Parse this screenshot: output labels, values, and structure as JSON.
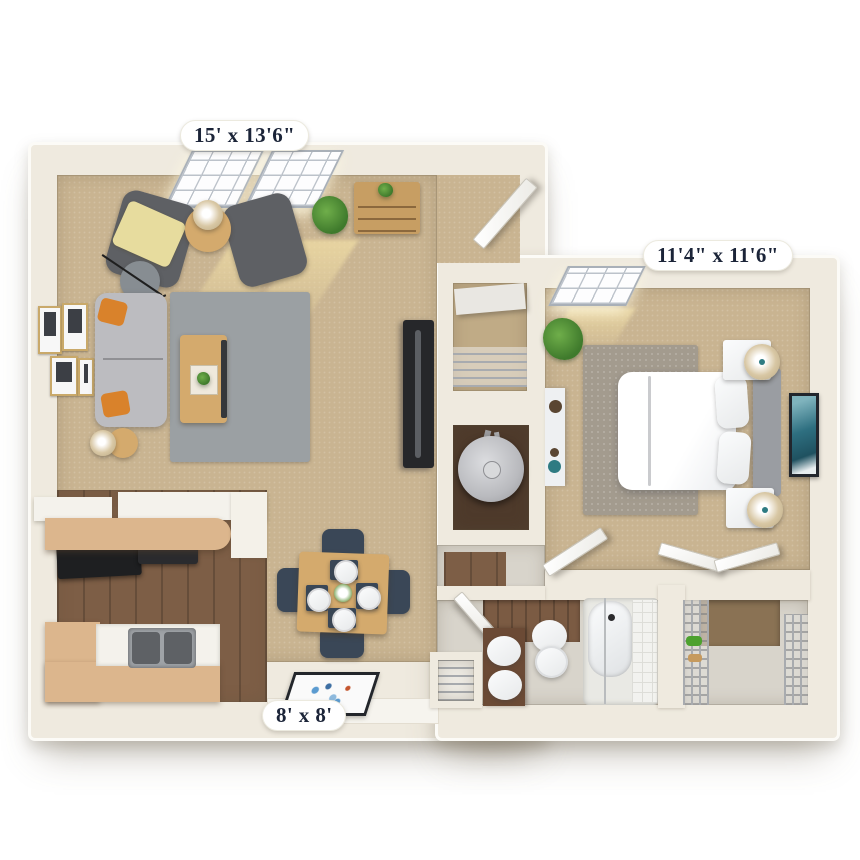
{
  "floorplan": {
    "type": "3d-apartment-floor-plan",
    "labels": {
      "living_room": "15' x 13'6\"",
      "bedroom": "11'4\" x 11'6\"",
      "dining": "8' x 8'"
    },
    "rooms": [
      "living-room",
      "dining-nook",
      "kitchen",
      "entry",
      "coat-closet",
      "utility-closet",
      "hallway",
      "bedroom",
      "bathroom",
      "linen-closet",
      "walk-in-closet"
    ],
    "furniture": [
      "sofa",
      "armchair",
      "armchair",
      "coffee-table",
      "area-rug",
      "floor-lamp",
      "side-table",
      "accent-table",
      "bookshelf",
      "tv-stand",
      "wall-pictures",
      "potted-plant",
      "dining-table",
      "dining-chairs",
      "doormat",
      "breakfast-bar",
      "range",
      "kitchen-sink",
      "bed",
      "headboard",
      "nightstand",
      "nightstand",
      "table-lamp",
      "dresser",
      "wall-art",
      "bedroom-rug",
      "toilet",
      "bathtub",
      "vanity-sink",
      "water-heater",
      "wire-shelving"
    ],
    "colors": {
      "page_bg": "#ffffff",
      "wall": "#efeadf",
      "wall_edge": "#fcfbf7",
      "carpet": "#c9b491",
      "carpet_dark": "#c0ab86",
      "wood_floor": "#7d5e46",
      "counter_wood": "#dcb68d",
      "cabinet_white": "#f4f2ec",
      "tile_floor": "#d8d4cb",
      "rug_living": "#9ba0a3",
      "rug_bedroom": "#a39b8e",
      "sofa_gray": "#bcbcc0",
      "armchair_gray": "#5e6064",
      "pillow_orange": "#d9822b",
      "throw_yellow": "#e7dc9e",
      "table_wood": "#d4aa6d",
      "chair_navy": "#3a4757",
      "plant_green": "#3f7a2c",
      "lamp_tan": "#d8c7a4",
      "steel": "#a8abaf",
      "tv_black": "#26272a",
      "bath_wood_wall": "#7b5b43",
      "vanity_brown": "#6b4a35",
      "heater_floor_brown": "#4e3a2b",
      "label_bg": "#ffffff",
      "label_text": "#1b2438"
    }
  }
}
